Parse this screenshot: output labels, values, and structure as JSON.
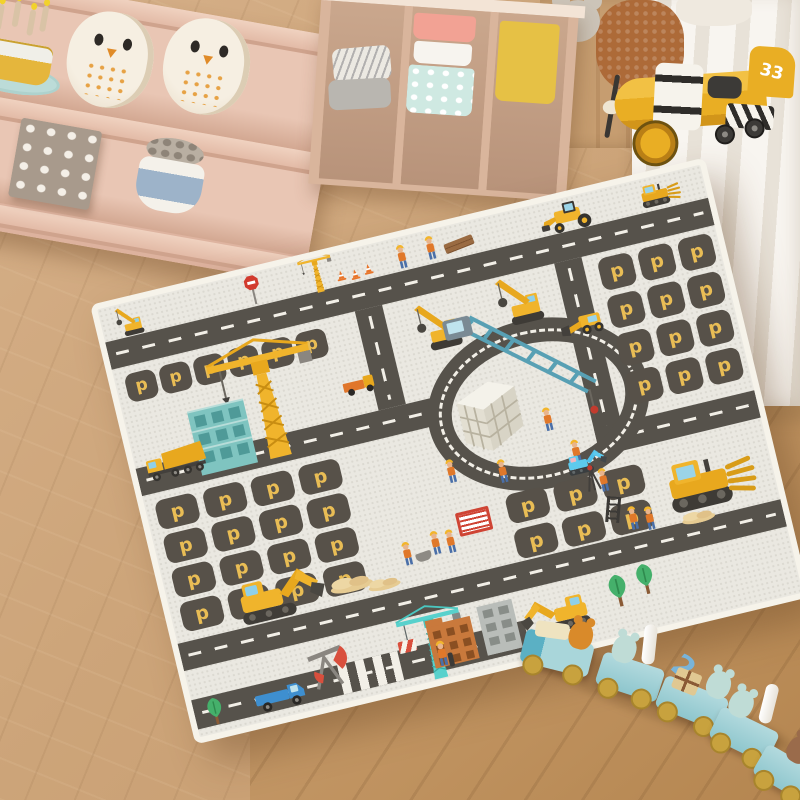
{
  "scene": {
    "alt": "Children's playroom: construction-themed road play mat on wood floor, pink shelves with toys, yellow toy airplane, wooden animal train",
    "colors": {
      "wood_floor": "#cda87c",
      "wood_floor_dark": "#b4854f",
      "shelf_pink": "#e6c0ad",
      "mat_base": "#eae8e1",
      "mat_edge": "#f6f3ea",
      "road": "#56524b",
      "road_line": "#f2efe7",
      "parking_bg": "#575149",
      "parking_letter_color": "#e9bd55",
      "vehicle_yellow": "#f0b42c",
      "crane_teal": "#5aa7b0",
      "train_blue": "#a9d6da",
      "curtain": "#f5f1ea"
    }
  },
  "mat": {
    "parking_letter": "p"
  },
  "toys": {
    "airplane": {
      "tail_number": "33"
    },
    "train": {
      "car_number": "2"
    }
  }
}
